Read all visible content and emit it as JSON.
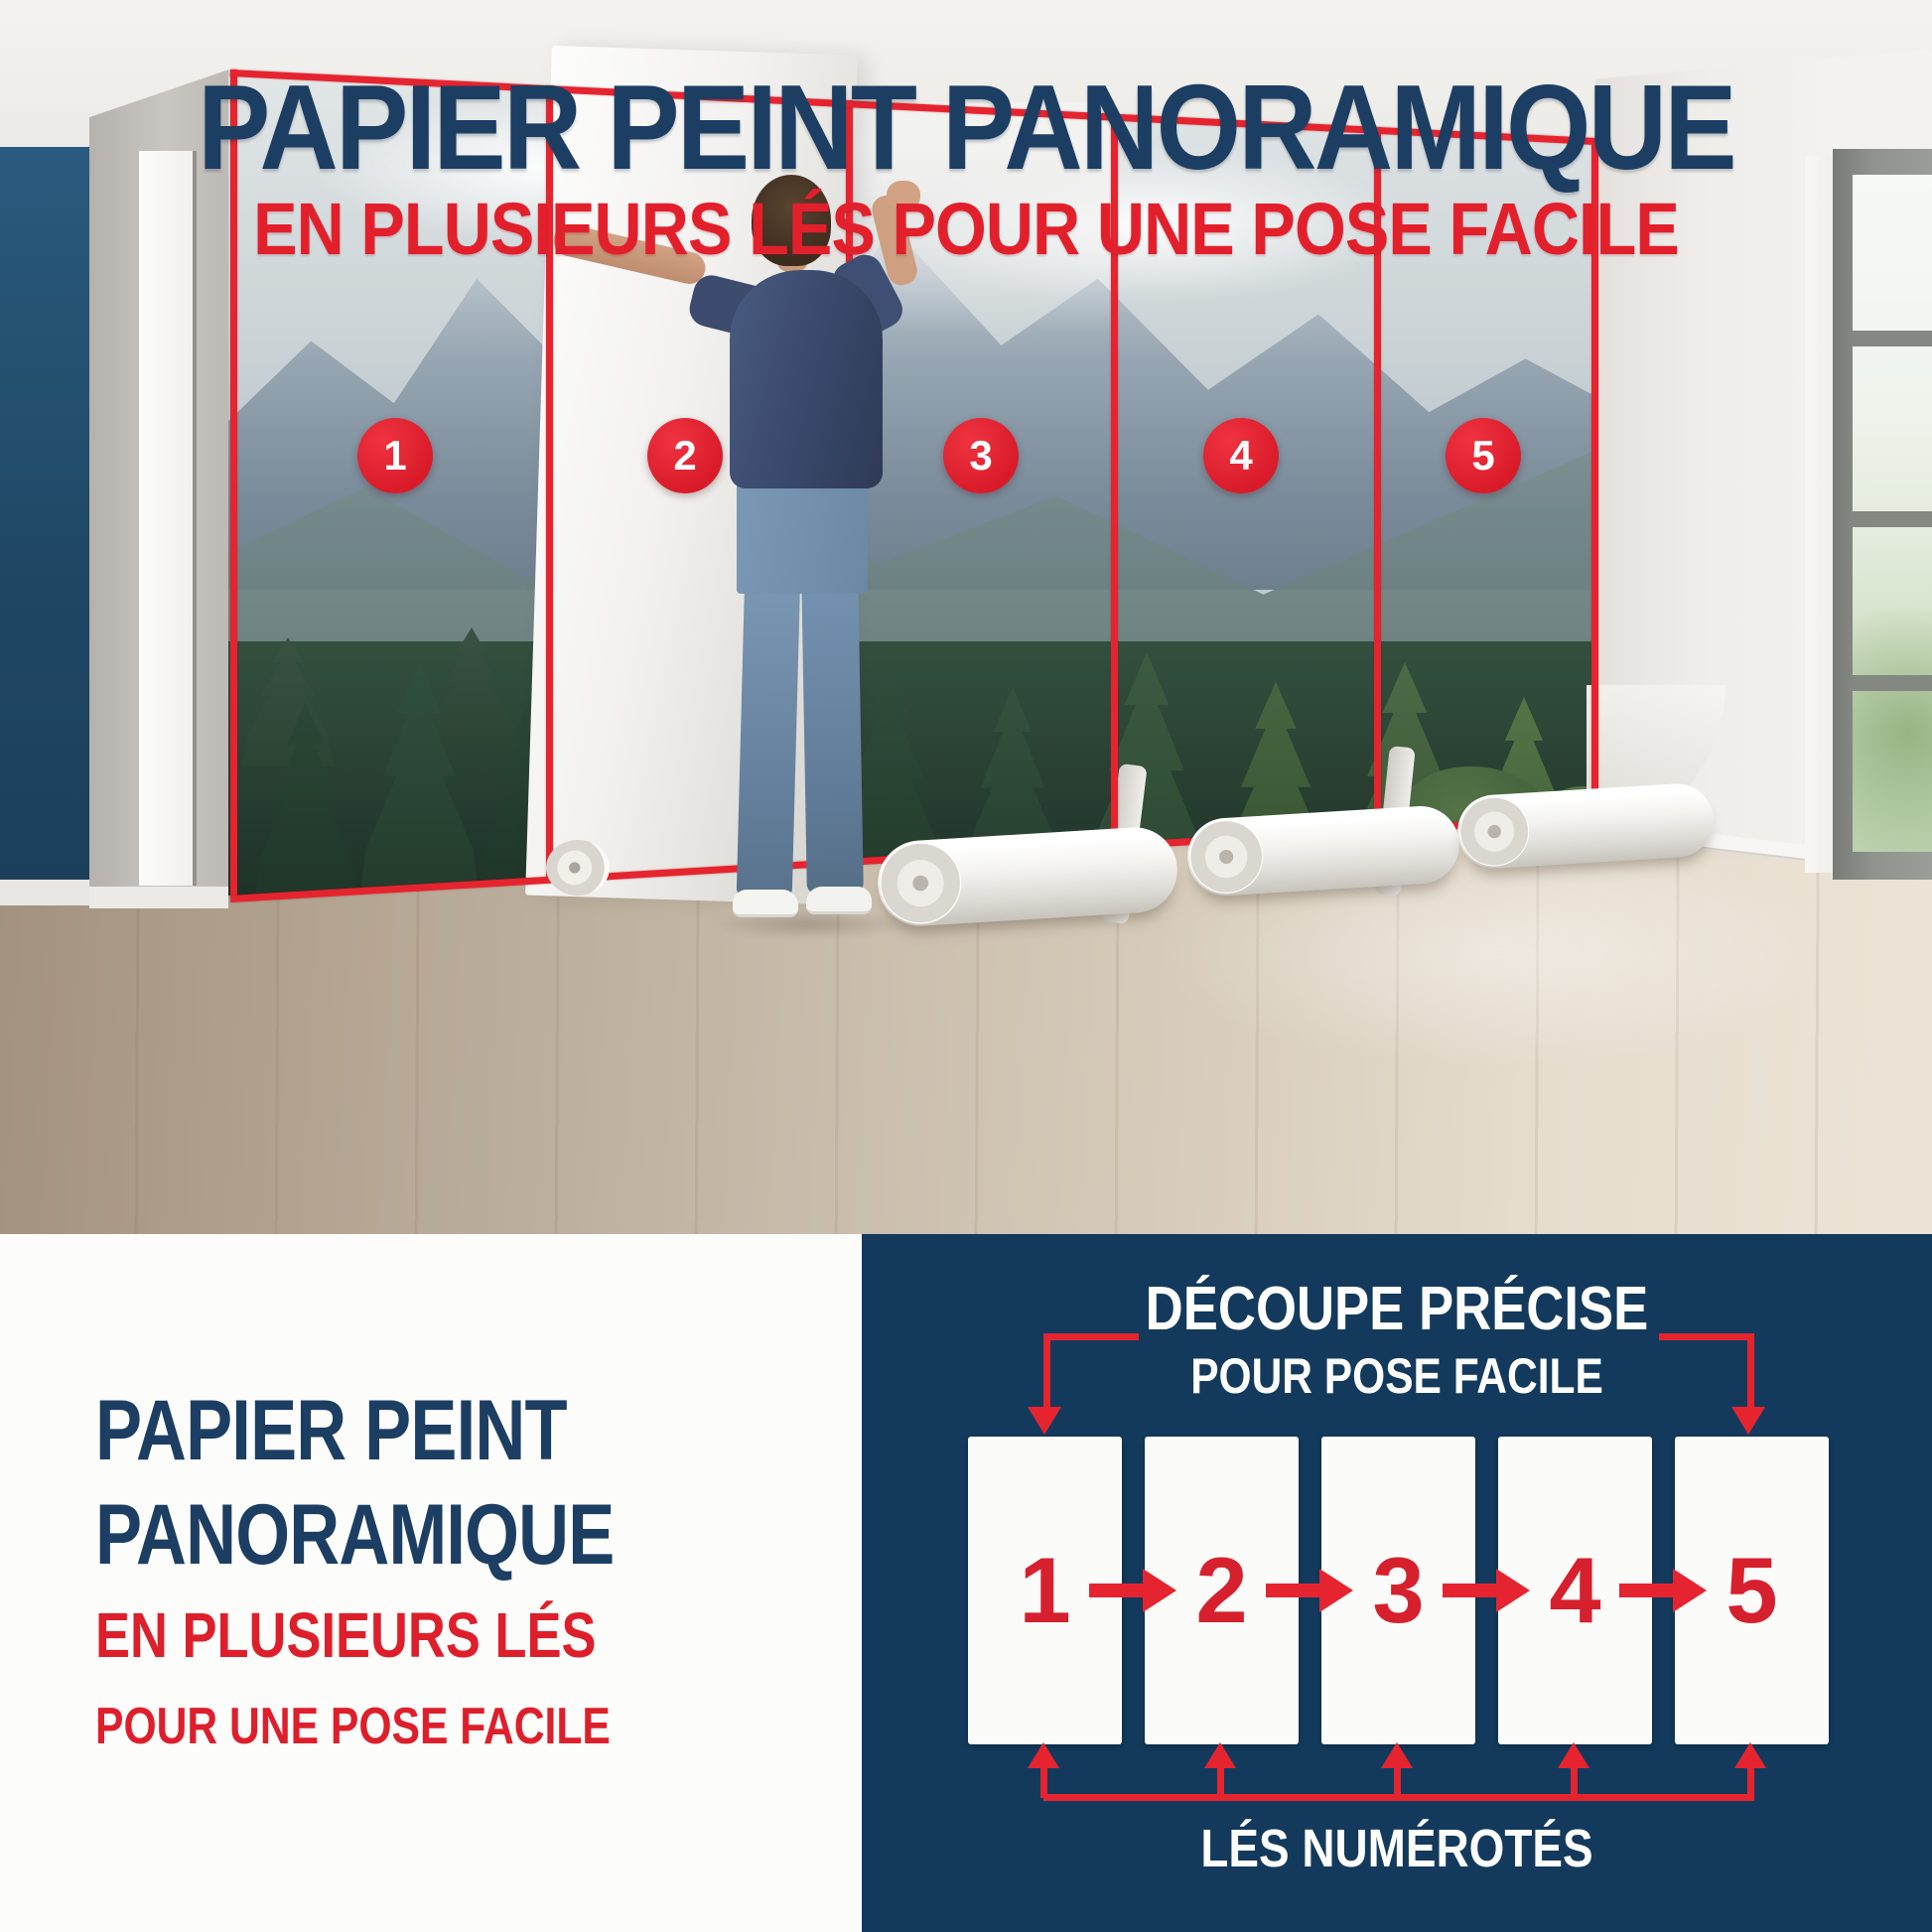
{
  "colors": {
    "navy_text": "#1d3e63",
    "red_accent": "#e2202c",
    "diagram_background": "#133a5c",
    "accent_wall_navy": "#1f4764"
  },
  "header": {
    "title": "PAPIER PEINT PANORAMIQUE",
    "subtitle": "EN PLUSIEURS LÉS POUR UNE POSE FACILE"
  },
  "photo": {
    "strip_labels": [
      "1",
      "2",
      "3",
      "4",
      "5"
    ]
  },
  "bottom_left": {
    "title_line1": "PAPIER PEINT",
    "title_line2": "PANORAMIQUE",
    "subtitle_line1": "EN PLUSIEURS LÉS",
    "subtitle_line2": "POUR UNE POSE FACILE"
  },
  "diagram": {
    "title_line1": "DÉCOUPE PRÉCISE",
    "title_line2": "POUR POSE FACILE",
    "strip_labels": [
      "1",
      "2",
      "3",
      "4",
      "5"
    ],
    "caption": "LÉS NUMÉROTÉS"
  }
}
